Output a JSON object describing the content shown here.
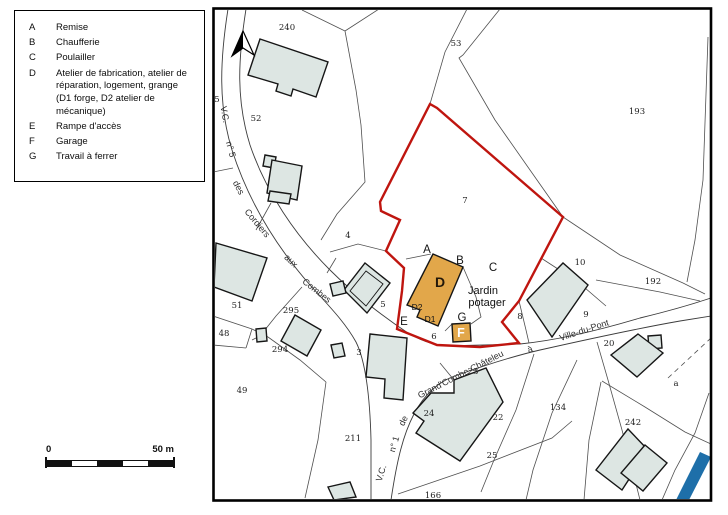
{
  "legend": {
    "items": [
      {
        "key": "A",
        "label": "Remise"
      },
      {
        "key": "B",
        "label": "Chaufferie"
      },
      {
        "key": "C",
        "label": "Poulailler"
      },
      {
        "key": "D",
        "label": "Atelier de fabrication, atelier de\nréparation, logement, grange\n (D1 forge, D2 atelier de\n mécanique)"
      },
      {
        "key": "E",
        "label": "Rampe d'accès"
      },
      {
        "key": "F",
        "label": "Garage"
      },
      {
        "key": "G",
        "label": "Travail à ferrer"
      }
    ]
  },
  "scale_bar": {
    "start": "0",
    "end": "50 m"
  },
  "map": {
    "colors": {
      "building_fill": "#dde6e3",
      "farm_building_fill": "#e2a74a",
      "protection_boundary_red": "#bf150f",
      "stream_blue": "#1e6fa9"
    },
    "jardin_potager": [
      {
        "t": "Jardin",
        "x": 483,
        "y": 294
      },
      {
        "t": "potager",
        "x": 487,
        "y": 306
      }
    ],
    "building_letters": [
      {
        "t": "A",
        "x": 427,
        "y": 253
      },
      {
        "t": "B",
        "x": 460,
        "y": 264
      },
      {
        "t": "C",
        "x": 493,
        "y": 271
      },
      {
        "t": "D",
        "x": 440,
        "y": 287,
        "cls": "letter-d"
      },
      {
        "t": "D2",
        "x": 417,
        "y": 310,
        "cls": "sub"
      },
      {
        "t": "D1",
        "x": 430,
        "y": 322,
        "cls": "sub"
      },
      {
        "t": "E",
        "x": 404,
        "y": 325
      },
      {
        "t": "G",
        "x": 462,
        "y": 321
      },
      {
        "t": "F",
        "x": 461,
        "y": 337,
        "cls": "letter-f"
      }
    ],
    "parcel_numbers": [
      {
        "t": "240",
        "x": 287,
        "y": 30
      },
      {
        "t": "53",
        "x": 456,
        "y": 46
      },
      {
        "t": "193",
        "x": 637,
        "y": 114
      },
      {
        "t": "52",
        "x": 256,
        "y": 121
      },
      {
        "t": "5",
        "x": 217,
        "y": 102
      },
      {
        "t": "7",
        "x": 465,
        "y": 203
      },
      {
        "t": "4",
        "x": 348,
        "y": 238
      },
      {
        "t": "51",
        "x": 237,
        "y": 308
      },
      {
        "t": "295",
        "x": 291,
        "y": 313
      },
      {
        "t": "5",
        "x": 383,
        "y": 307
      },
      {
        "t": "48",
        "x": 224,
        "y": 336
      },
      {
        "t": "294",
        "x": 280,
        "y": 352
      },
      {
        "t": "3",
        "x": 359,
        "y": 355
      },
      {
        "t": "49",
        "x": 242,
        "y": 393
      },
      {
        "t": "211",
        "x": 353,
        "y": 441
      },
      {
        "t": "6",
        "x": 434,
        "y": 339
      },
      {
        "t": "8",
        "x": 520,
        "y": 319
      },
      {
        "t": "9",
        "x": 586,
        "y": 317
      },
      {
        "t": "10",
        "x": 580,
        "y": 265
      },
      {
        "t": "192",
        "x": 653,
        "y": 284
      },
      {
        "t": "20",
        "x": 609,
        "y": 346
      },
      {
        "t": "23",
        "x": 473,
        "y": 374
      },
      {
        "t": "22",
        "x": 498,
        "y": 420
      },
      {
        "t": "24",
        "x": 429,
        "y": 416
      },
      {
        "t": "25",
        "x": 492,
        "y": 458
      },
      {
        "t": "134",
        "x": 558,
        "y": 410
      },
      {
        "t": "242",
        "x": 633,
        "y": 425
      },
      {
        "t": "a",
        "x": 676,
        "y": 386
      },
      {
        "t": "166",
        "x": 433,
        "y": 498
      }
    ],
    "road_labels": [
      {
        "t": "V.C.",
        "x": 222,
        "y": 115,
        "r": 80
      },
      {
        "t": "n° 5",
        "x": 228,
        "y": 150,
        "r": 75
      },
      {
        "t": "des",
        "x": 236,
        "y": 189,
        "r": 62
      },
      {
        "t": "Cordiers",
        "x": 255,
        "y": 225,
        "r": 50
      },
      {
        "t": "aux",
        "x": 289,
        "y": 263,
        "r": 44
      },
      {
        "t": "Combes",
        "x": 315,
        "y": 293,
        "r": 38
      },
      {
        "t": "V.C.",
        "x": 384,
        "y": 474,
        "r": -73
      },
      {
        "t": "n° 1",
        "x": 397,
        "y": 445,
        "r": -73
      },
      {
        "t": "de",
        "x": 406,
        "y": 422,
        "r": -65
      },
      {
        "t": "Grand'Combe-Châteleu",
        "x": 462,
        "y": 377,
        "r": -27
      },
      {
        "t": "à",
        "x": 531,
        "y": 352,
        "r": -20
      },
      {
        "t": "Ville-du-Pont",
        "x": 585,
        "y": 333,
        "r": -18
      }
    ]
  }
}
